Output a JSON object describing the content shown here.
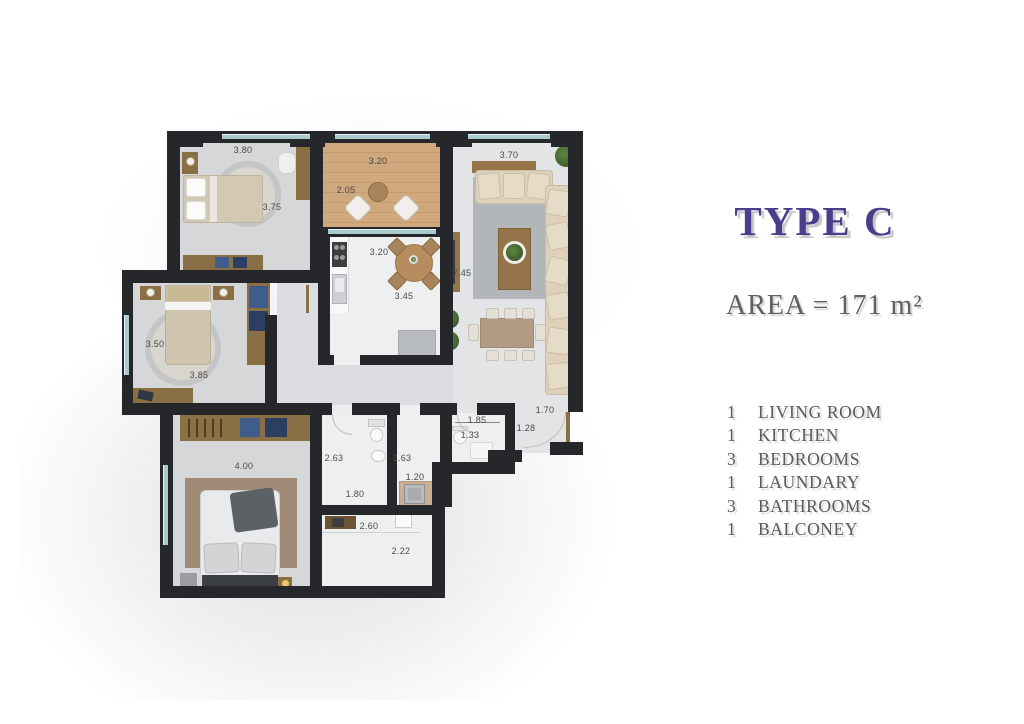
{
  "panel": {
    "title": "TYPE C",
    "area": "AREA = 171 m²",
    "rooms": [
      {
        "count": "1",
        "name": "LIVING ROOM"
      },
      {
        "count": "1",
        "name": "KITCHEN"
      },
      {
        "count": "3",
        "name": "BEDROOMS"
      },
      {
        "count": "1",
        "name": "LAUNDARY"
      },
      {
        "count": "3",
        "name": "BATHROOMS"
      },
      {
        "count": "1",
        "name": "BALCONEY"
      }
    ]
  },
  "plan": {
    "dims": [
      "3.80",
      "3.75",
      "3.20",
      "2.05",
      "3.70",
      "7.45",
      "3.20",
      "3.45",
      "3.50",
      "3.85",
      "4.00",
      "2.63",
      "1.80",
      "2.63",
      "1.20",
      "2.60",
      "2.22",
      "1.85",
      "1.33",
      "1.28",
      "1.70"
    ]
  },
  "colors": {
    "accent_purple": "#4a3e8c",
    "panel_text_gray": "#5b5a57",
    "wall": "#26272a",
    "wood_furniture": "#8a6f45",
    "balcony_wood": "#cfa87d",
    "bedroom_floor": "#d6d7d9",
    "wet_room_floor": "#eef0f0",
    "sofa_beige": "#ddd1ba",
    "rug_gray": "#b3b6b8",
    "window_glass": "#a9cbcd"
  }
}
